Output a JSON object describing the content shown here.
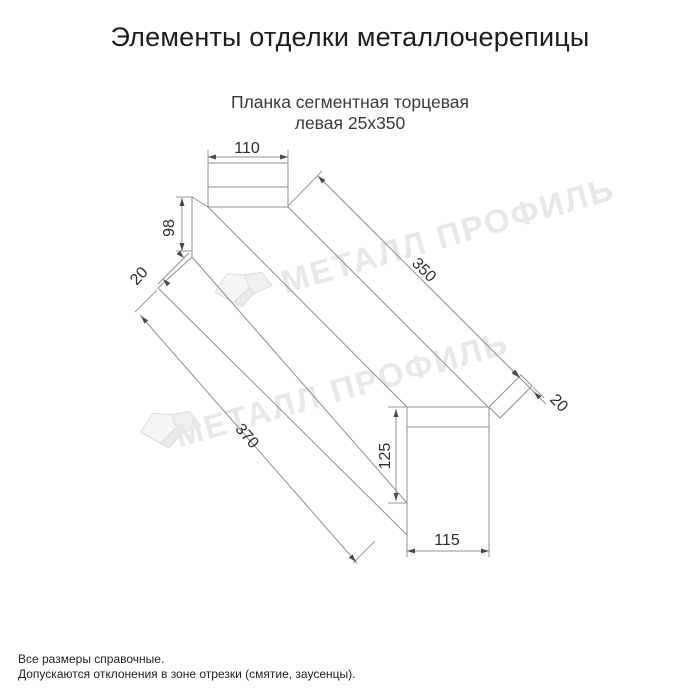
{
  "header": {
    "title": "Элементы отделки металлочерепицы"
  },
  "product": {
    "name_line1": "Планка сегментная торцевая",
    "name_line2": "левая 25х350"
  },
  "diagram": {
    "type": "technical-drawing",
    "dims": {
      "d110": "110",
      "d98": "98",
      "d20_left": "20",
      "d350": "350",
      "d370": "370",
      "d20_right": "20",
      "d125": "125",
      "d115": "115"
    }
  },
  "watermark": {
    "text": "МЕТАЛЛ ПРОФИЛЬ"
  },
  "footnotes": {
    "line1": "Все размеры справочные.",
    "line2": "Допускаются отклонения в зоне отрезки (смятие, заусенцы)."
  },
  "colors": {
    "background": "#ffffff",
    "title_text": "#1d1d1d",
    "subtitle_text": "#3a3a3a",
    "drawing_line": "#909090",
    "dimension_text": "#2d2d2d",
    "watermark": "#e8e8ea"
  }
}
